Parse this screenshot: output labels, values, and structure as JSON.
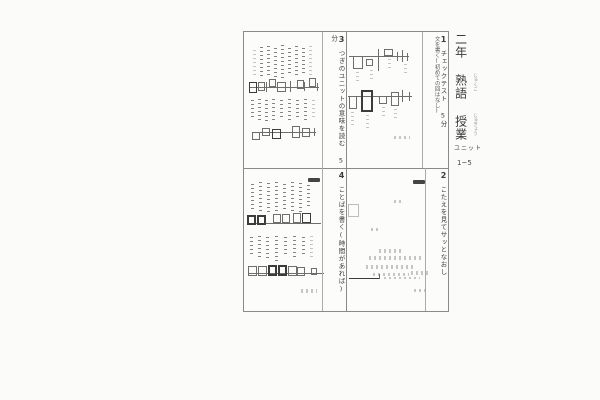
{
  "document": {
    "header": {
      "grade_title": "二年 熟語 授業",
      "furigana_jukugo": "じゅくご",
      "furigana_jugyou": "じゅぎょう",
      "unit_label": "ユニット",
      "unit_range": "1~5"
    },
    "panels": [
      {
        "number": "1",
        "title": "チェックテスト 5分",
        "subtitle": "文を書く(初めての回はなし)"
      },
      {
        "number": "2",
        "title": "こたえを見てサッとなおし",
        "subtitle": ""
      },
      {
        "number": "3",
        "title": "つぎのユニットの意味を読む 5分",
        "subtitle": ""
      },
      {
        "number": "4",
        "title": "ことばを書く(時間があれば)",
        "subtitle": ""
      }
    ],
    "sketches": {
      "panel3": [
        {
          "t": "sv",
          "x": 9,
          "y": 18,
          "h": 26,
          "s": "light"
        },
        {
          "t": "sv",
          "x": 16,
          "y": 15,
          "h": 32
        },
        {
          "t": "sv",
          "x": 23,
          "y": 14,
          "h": 30
        },
        {
          "t": "sv",
          "x": 30,
          "y": 16,
          "h": 30
        },
        {
          "t": "sv",
          "x": 37,
          "y": 13,
          "h": 34
        },
        {
          "t": "sv",
          "x": 44,
          "y": 16,
          "h": 28
        },
        {
          "t": "sv",
          "x": 51,
          "y": 14,
          "h": 32
        },
        {
          "t": "sv",
          "x": 58,
          "y": 16,
          "h": 26
        },
        {
          "t": "sv",
          "x": 65,
          "y": 14,
          "h": 30,
          "s": "light"
        },
        {
          "t": "hl",
          "x": 5,
          "y": 55,
          "w": 70
        },
        {
          "t": "box",
          "x": 5,
          "y": 50,
          "w": 8,
          "h": 11,
          "s": "dark"
        },
        {
          "t": "box",
          "x": 14,
          "y": 50,
          "w": 7,
          "h": 9
        },
        {
          "t": "box",
          "x": 25,
          "y": 47,
          "w": 7,
          "h": 8
        },
        {
          "t": "box",
          "x": 33,
          "y": 50,
          "w": 9,
          "h": 10
        },
        {
          "t": "box",
          "x": 53,
          "y": 48,
          "w": 7,
          "h": 9
        },
        {
          "t": "box",
          "x": 65,
          "y": 46,
          "w": 7,
          "h": 9
        },
        {
          "t": "vl",
          "x": 22,
          "y": 50,
          "h": 10
        },
        {
          "t": "vl",
          "x": 46,
          "y": 49,
          "h": 11
        },
        {
          "t": "vl",
          "x": 60,
          "y": 50,
          "h": 9
        },
        {
          "t": "vl",
          "x": 73,
          "y": 51,
          "h": 8
        },
        {
          "t": "sv",
          "x": 7,
          "y": 68,
          "h": 20
        },
        {
          "t": "sv",
          "x": 14,
          "y": 67,
          "h": 24
        },
        {
          "t": "sv",
          "x": 21,
          "y": 68,
          "h": 22
        },
        {
          "t": "sv",
          "x": 28,
          "y": 67,
          "h": 24
        },
        {
          "t": "sv",
          "x": 36,
          "y": 68,
          "h": 20
        },
        {
          "t": "sv",
          "x": 44,
          "y": 67,
          "h": 23
        },
        {
          "t": "sv",
          "x": 52,
          "y": 68,
          "h": 20
        },
        {
          "t": "sv",
          "x": 60,
          "y": 67,
          "h": 22
        },
        {
          "t": "sv",
          "x": 68,
          "y": 68,
          "h": 18,
          "s": "light"
        },
        {
          "t": "hl",
          "x": 8,
          "y": 100,
          "w": 64
        },
        {
          "t": "box",
          "x": 8,
          "y": 100,
          "w": 8,
          "h": 8
        },
        {
          "t": "box",
          "x": 18,
          "y": 96,
          "w": 8,
          "h": 8
        },
        {
          "t": "box",
          "x": 28,
          "y": 97,
          "w": 9,
          "h": 10,
          "s": "dark"
        },
        {
          "t": "box",
          "x": 48,
          "y": 94,
          "w": 8,
          "h": 12
        },
        {
          "t": "box",
          "x": 58,
          "y": 96,
          "w": 8,
          "h": 9
        },
        {
          "t": "vl",
          "x": 70,
          "y": 96,
          "h": 8
        }
      ],
      "panel1": [
        {
          "t": "hl",
          "x": 105,
          "y": 24,
          "w": 60
        },
        {
          "t": "box",
          "x": 109,
          "y": 24,
          "w": 10,
          "h": 13
        },
        {
          "t": "box",
          "x": 122,
          "y": 27,
          "w": 7,
          "h": 7
        },
        {
          "t": "vl",
          "x": 134,
          "y": 17,
          "h": 22
        },
        {
          "t": "box",
          "x": 140,
          "y": 17,
          "w": 9,
          "h": 7
        },
        {
          "t": "vl",
          "x": 153,
          "y": 20,
          "h": 9
        },
        {
          "t": "vl",
          "x": 158,
          "y": 18,
          "h": 12
        },
        {
          "t": "vl",
          "x": 163,
          "y": 21,
          "h": 8
        },
        {
          "t": "sv",
          "x": 112,
          "y": 40,
          "h": 12,
          "s": "light"
        },
        {
          "t": "sv",
          "x": 126,
          "y": 38,
          "h": 12,
          "s": "light"
        },
        {
          "t": "sv",
          "x": 144,
          "y": 27,
          "h": 10,
          "s": "light"
        },
        {
          "t": "sv",
          "x": 160,
          "y": 32,
          "h": 12,
          "s": "light"
        },
        {
          "t": "hl",
          "x": 104,
          "y": 64,
          "w": 64
        },
        {
          "t": "box",
          "x": 105,
          "y": 64,
          "w": 8,
          "h": 13
        },
        {
          "t": "box",
          "x": 117,
          "y": 58,
          "w": 12,
          "h": 22,
          "s": "dark",
          "b": 1
        },
        {
          "t": "box",
          "x": 135,
          "y": 64,
          "w": 8,
          "h": 8
        },
        {
          "t": "box",
          "x": 147,
          "y": 60,
          "w": 8,
          "h": 14
        },
        {
          "t": "vl",
          "x": 158,
          "y": 58,
          "h": 12
        },
        {
          "t": "vl",
          "x": 165,
          "y": 60,
          "h": 9
        },
        {
          "t": "sv",
          "x": 107,
          "y": 80,
          "h": 14,
          "s": "light"
        },
        {
          "t": "sv",
          "x": 122,
          "y": 83,
          "h": 14,
          "s": "light"
        },
        {
          "t": "sv",
          "x": 138,
          "y": 75,
          "h": 12,
          "s": "light"
        },
        {
          "t": "sv",
          "x": 150,
          "y": 77,
          "h": 12,
          "s": "light"
        },
        {
          "t": "sh",
          "x": 150,
          "y": 104,
          "w": 16,
          "h": 3,
          "s": "light"
        }
      ],
      "panel4": [
        {
          "t": "blob",
          "x": 64,
          "y": 146,
          "w": 12,
          "h": 4
        },
        {
          "t": "sv",
          "x": 7,
          "y": 152,
          "h": 28
        },
        {
          "t": "sv",
          "x": 15,
          "y": 150,
          "h": 32
        },
        {
          "t": "sv",
          "x": 23,
          "y": 151,
          "h": 30
        },
        {
          "t": "sv",
          "x": 31,
          "y": 150,
          "h": 31
        },
        {
          "t": "sv",
          "x": 39,
          "y": 152,
          "h": 28
        },
        {
          "t": "sv",
          "x": 47,
          "y": 150,
          "h": 30
        },
        {
          "t": "sv",
          "x": 55,
          "y": 151,
          "h": 29
        },
        {
          "t": "sv",
          "x": 63,
          "y": 153,
          "h": 24
        },
        {
          "t": "hl",
          "x": 3,
          "y": 191,
          "w": 74
        },
        {
          "t": "box",
          "x": 3,
          "y": 183,
          "w": 9,
          "h": 10,
          "s": "dark",
          "b": 1
        },
        {
          "t": "box",
          "x": 13,
          "y": 183,
          "w": 9,
          "h": 10,
          "s": "dark",
          "b": 1
        },
        {
          "t": "box",
          "x": 29,
          "y": 182,
          "w": 8,
          "h": 9
        },
        {
          "t": "box",
          "x": 38,
          "y": 182,
          "w": 8,
          "h": 9
        },
        {
          "t": "box",
          "x": 49,
          "y": 181,
          "w": 8,
          "h": 10
        },
        {
          "t": "box",
          "x": 58,
          "y": 181,
          "w": 9,
          "h": 10,
          "s": "dark"
        },
        {
          "t": "sv",
          "x": 6,
          "y": 205,
          "h": 20
        },
        {
          "t": "sv",
          "x": 14,
          "y": 204,
          "h": 24
        },
        {
          "t": "sv",
          "x": 22,
          "y": 205,
          "h": 22
        },
        {
          "t": "sv",
          "x": 31,
          "y": 204,
          "h": 25
        },
        {
          "t": "sv",
          "x": 40,
          "y": 205,
          "h": 20
        },
        {
          "t": "sv",
          "x": 49,
          "y": 204,
          "h": 24
        },
        {
          "t": "sv",
          "x": 58,
          "y": 205,
          "h": 20
        },
        {
          "t": "sv",
          "x": 66,
          "y": 204,
          "h": 22,
          "s": "light"
        },
        {
          "t": "hl",
          "x": 4,
          "y": 241,
          "w": 76
        },
        {
          "t": "box",
          "x": 4,
          "y": 234,
          "w": 9,
          "h": 10
        },
        {
          "t": "box",
          "x": 14,
          "y": 234,
          "w": 9,
          "h": 10
        },
        {
          "t": "box",
          "x": 24,
          "y": 233,
          "w": 9,
          "h": 11,
          "s": "dark",
          "b": 1
        },
        {
          "t": "box",
          "x": 34,
          "y": 233,
          "w": 9,
          "h": 11,
          "s": "dark",
          "b": 1
        },
        {
          "t": "box",
          "x": 44,
          "y": 234,
          "w": 9,
          "h": 10
        },
        {
          "t": "box",
          "x": 53,
          "y": 235,
          "w": 8,
          "h": 9
        },
        {
          "t": "box",
          "x": 67,
          "y": 236,
          "w": 6,
          "h": 7
        },
        {
          "t": "vl",
          "x": 78,
          "y": 237,
          "h": 8
        },
        {
          "t": "sh",
          "x": 57,
          "y": 257,
          "w": 16,
          "h": 4,
          "s": "light"
        }
      ],
      "panel2": [
        {
          "t": "blob",
          "x": 169,
          "y": 148,
          "w": 12,
          "h": 4
        },
        {
          "t": "box",
          "x": 104,
          "y": 172,
          "w": 11,
          "h": 13,
          "s": "light"
        },
        {
          "t": "sh",
          "x": 150,
          "y": 168,
          "w": 8,
          "h": 3,
          "s": "light"
        },
        {
          "t": "sh",
          "x": 127,
          "y": 196,
          "w": 8,
          "h": 3,
          "s": "light"
        },
        {
          "t": "sh",
          "x": 135,
          "y": 217,
          "w": 24,
          "h": 4,
          "s": "light"
        },
        {
          "t": "sh",
          "x": 125,
          "y": 224,
          "w": 52,
          "h": 4,
          "s": "light"
        },
        {
          "t": "sh",
          "x": 122,
          "y": 233,
          "w": 50,
          "h": 4,
          "s": "light"
        },
        {
          "t": "sh",
          "x": 129,
          "y": 241,
          "w": 36,
          "h": 3,
          "s": "light"
        },
        {
          "t": "hl",
          "x": 105,
          "y": 246,
          "w": 30,
          "s": "dark"
        },
        {
          "t": "vl",
          "x": 135,
          "y": 242,
          "h": 5
        },
        {
          "t": "sh",
          "x": 140,
          "y": 245,
          "w": 36,
          "h": 2,
          "s": "light"
        },
        {
          "t": "sh",
          "x": 167,
          "y": 239,
          "w": 18,
          "h": 4,
          "s": "light"
        },
        {
          "t": "sh",
          "x": 170,
          "y": 257,
          "w": 12,
          "h": 3,
          "s": "light"
        }
      ]
    }
  }
}
